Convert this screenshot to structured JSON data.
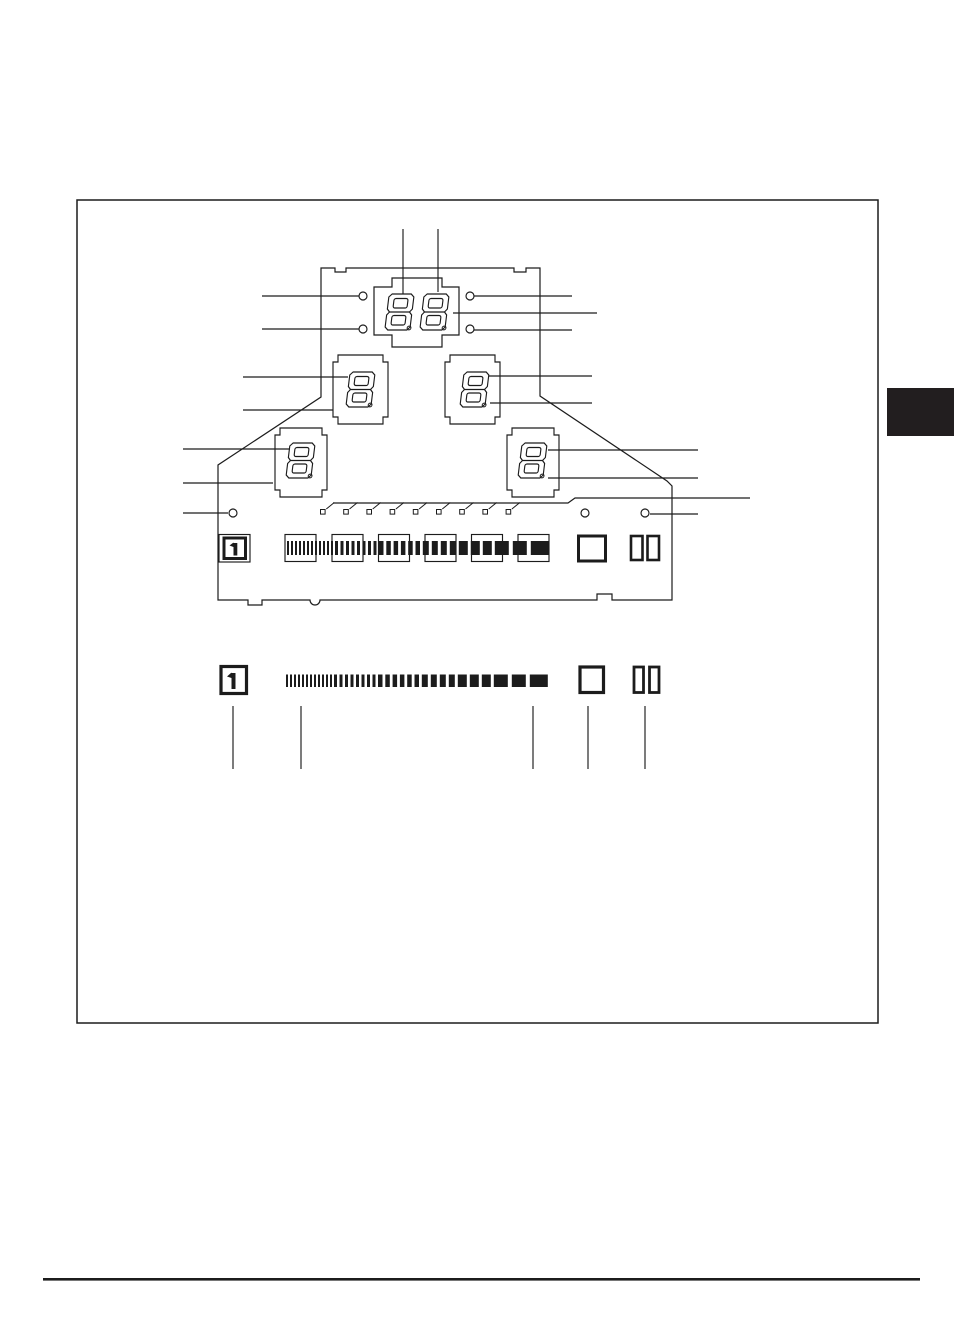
{
  "page": {
    "width": 954,
    "height": 1343,
    "background": "#ffffff",
    "ink": "#1c1c1c"
  },
  "frame": {
    "x": 77,
    "y": 200,
    "w": 801,
    "h": 823,
    "stroke_w": 1.5
  },
  "side_tab": {
    "x": 887,
    "y": 388,
    "w": 67,
    "h": 48,
    "color": "#221e1f"
  },
  "footer_rule": {
    "x": 43,
    "y": 1278,
    "w": 877,
    "h": 2.6
  },
  "display": {
    "panel_outline": "M321,268 H335 V272 H346 V268 H514 V272 H526 V268 H540 V396 L667,481 L672,486 V600 H612 V594 H597 V600 H320 A5,5 0 0 1 310,600 H262 V605 H248 V600 H218 V465 L321,397 Z",
    "two_digit_box": "M374,287 H392 V278 H442 V287 H459 V335 H442 V347 H392 V335 H374 Z",
    "digit_boxes": [
      {
        "x": 333,
        "y": 355,
        "w": 55,
        "h": 69
      },
      {
        "x": 445,
        "y": 355,
        "w": 55,
        "h": 69
      },
      {
        "x": 275,
        "y": 428,
        "w": 52,
        "h": 69
      },
      {
        "x": 507,
        "y": 428,
        "w": 52,
        "h": 69
      }
    ],
    "box_notch": {
      "nx": 5,
      "ny": 7,
      "stroke": 1.15
    },
    "digits": [
      {
        "x": 387,
        "y": 294,
        "w": 25,
        "h": 36,
        "value": "8",
        "dp": true
      },
      {
        "x": 422,
        "y": 294,
        "w": 25,
        "h": 36,
        "value": "8",
        "dp": true
      },
      {
        "x": 348,
        "y": 372,
        "w": 25,
        "h": 35,
        "value": "8",
        "dp": true
      },
      {
        "x": 462,
        "y": 372,
        "w": 25,
        "h": 35,
        "value": "8",
        "dp": true
      },
      {
        "x": 288,
        "y": 443,
        "w": 25,
        "h": 35,
        "value": "8",
        "dp": true
      },
      {
        "x": 520,
        "y": 443,
        "w": 25,
        "h": 35,
        "value": "8",
        "dp": true
      }
    ],
    "digit_style": {
      "corner": 3,
      "pinch": 2.5,
      "inner_inset": 5.5,
      "inner_pad": 4.5,
      "skew_deg": -7,
      "stroke": 1.15,
      "dp_r": 1.9
    },
    "top_pointer_lines": [
      [
        403,
        229,
        403,
        294
      ],
      [
        438,
        229,
        438,
        292
      ]
    ],
    "leader_lines": [
      [
        262,
        296,
        359,
        296
      ],
      [
        262,
        329,
        359,
        329
      ],
      [
        243,
        377,
        348,
        377
      ],
      [
        243,
        410,
        333,
        410
      ],
      [
        183,
        449,
        290,
        449
      ],
      [
        183,
        483,
        273,
        483
      ],
      [
        183,
        513,
        228,
        513
      ],
      [
        474,
        296,
        572,
        296
      ],
      [
        453,
        313,
        597,
        313
      ],
      [
        474,
        330,
        572,
        330
      ],
      [
        489,
        376,
        592,
        376
      ],
      [
        490,
        403,
        592,
        403
      ],
      [
        548,
        450,
        698,
        450
      ],
      [
        548,
        478,
        698,
        478
      ],
      [
        650,
        514,
        698,
        514
      ]
    ],
    "jog_leader": "333,503 568,503 575,498 750,498",
    "indicator_dots": {
      "r": 4,
      "centers": [
        [
          363,
          296
        ],
        [
          470,
          296
        ],
        [
          363,
          329
        ],
        [
          470,
          329
        ],
        [
          233,
          513
        ],
        [
          585,
          513
        ],
        [
          645,
          513
        ]
      ]
    },
    "tick_marks": {
      "x0": 320.5,
      "step": 23.2,
      "count": 9,
      "sq": 4.6,
      "sq_y": 509.5,
      "dx1": 5.8,
      "dy1": -0.5,
      "dx2": 13.8,
      "dy2": -7
    },
    "icon_row": {
      "outer_box": {
        "x": 219,
        "y": 534.5,
        "w": 31,
        "h": 27.5,
        "sw": 1.15
      },
      "one_box": {
        "x": 224,
        "y": 538,
        "w": 21.5,
        "h": 20.5,
        "sw": 3
      },
      "one_bar": {
        "x": 233.5,
        "y": 543,
        "w": 3.8,
        "h": 12.5
      },
      "one_flag": "229.5,545.5 233.5,542.5 233.5,547",
      "strip": {
        "x": 287,
        "y": 541,
        "h": 14,
        "segments": [
          {
            "w": 2,
            "g": 2,
            "n": 12
          },
          {
            "w": 3,
            "g": 2.5,
            "n": 8
          },
          {
            "w": 4.5,
            "g": 2.8,
            "n": 6
          },
          {
            "w": 6,
            "g": 3,
            "n": 4
          },
          {
            "w": 9,
            "g": 3,
            "n": 3
          },
          {
            "w": 14,
            "g": 4,
            "n": 2
          },
          {
            "w": 18,
            "g": 0,
            "n": 1
          }
        ]
      },
      "overlay_boxes": {
        "xs": [
          285,
          332,
          378.5,
          425,
          471.5,
          518
        ],
        "y": 534.5,
        "w": 31,
        "h": 27,
        "sw": 1.15
      },
      "square": {
        "x": 578.5,
        "y": 536,
        "w": 27,
        "h": 25,
        "sw": 3
      },
      "bar_a": {
        "x": 631,
        "y": 536,
        "w": 11.5,
        "h": 24,
        "sw": 2.6
      },
      "bar_b": {
        "x": 647.5,
        "y": 536,
        "w": 11.5,
        "h": 24,
        "sw": 2.6
      }
    },
    "legend_row": {
      "one_box": {
        "x": 221,
        "y": 666.5,
        "w": 25.5,
        "h": 27,
        "sw": 3.2
      },
      "one_bar": {
        "x": 231.5,
        "y": 673,
        "w": 4,
        "h": 16
      },
      "one_flag": "227,676.5 231.5,672.5 231.5,678",
      "strip": {
        "x": 286,
        "y": 674.5,
        "h": 12.5,
        "segments": [
          {
            "w": 2,
            "g": 2,
            "n": 12
          },
          {
            "w": 3,
            "g": 2.5,
            "n": 8
          },
          {
            "w": 4.5,
            "g": 2.8,
            "n": 6
          },
          {
            "w": 6,
            "g": 3,
            "n": 4
          },
          {
            "w": 9,
            "g": 3,
            "n": 3
          },
          {
            "w": 14,
            "g": 4,
            "n": 2
          },
          {
            "w": 18,
            "g": 0,
            "n": 1
          }
        ]
      },
      "square": {
        "x": 580,
        "y": 667,
        "w": 23.5,
        "h": 25.5,
        "sw": 3.2
      },
      "bar_a": {
        "x": 634,
        "y": 667,
        "w": 9.5,
        "h": 25.5,
        "sw": 2.8
      },
      "bar_b": {
        "x": 649.5,
        "y": 667,
        "w": 9.5,
        "h": 25.5,
        "sw": 2.8
      },
      "pointer_lines": [
        [
          233,
          706,
          233,
          769
        ],
        [
          301,
          706,
          301,
          769
        ],
        [
          533,
          706,
          533,
          769
        ],
        [
          588,
          706,
          588,
          769
        ],
        [
          645,
          706,
          645,
          769
        ]
      ]
    },
    "line_stroke": 1.15
  }
}
